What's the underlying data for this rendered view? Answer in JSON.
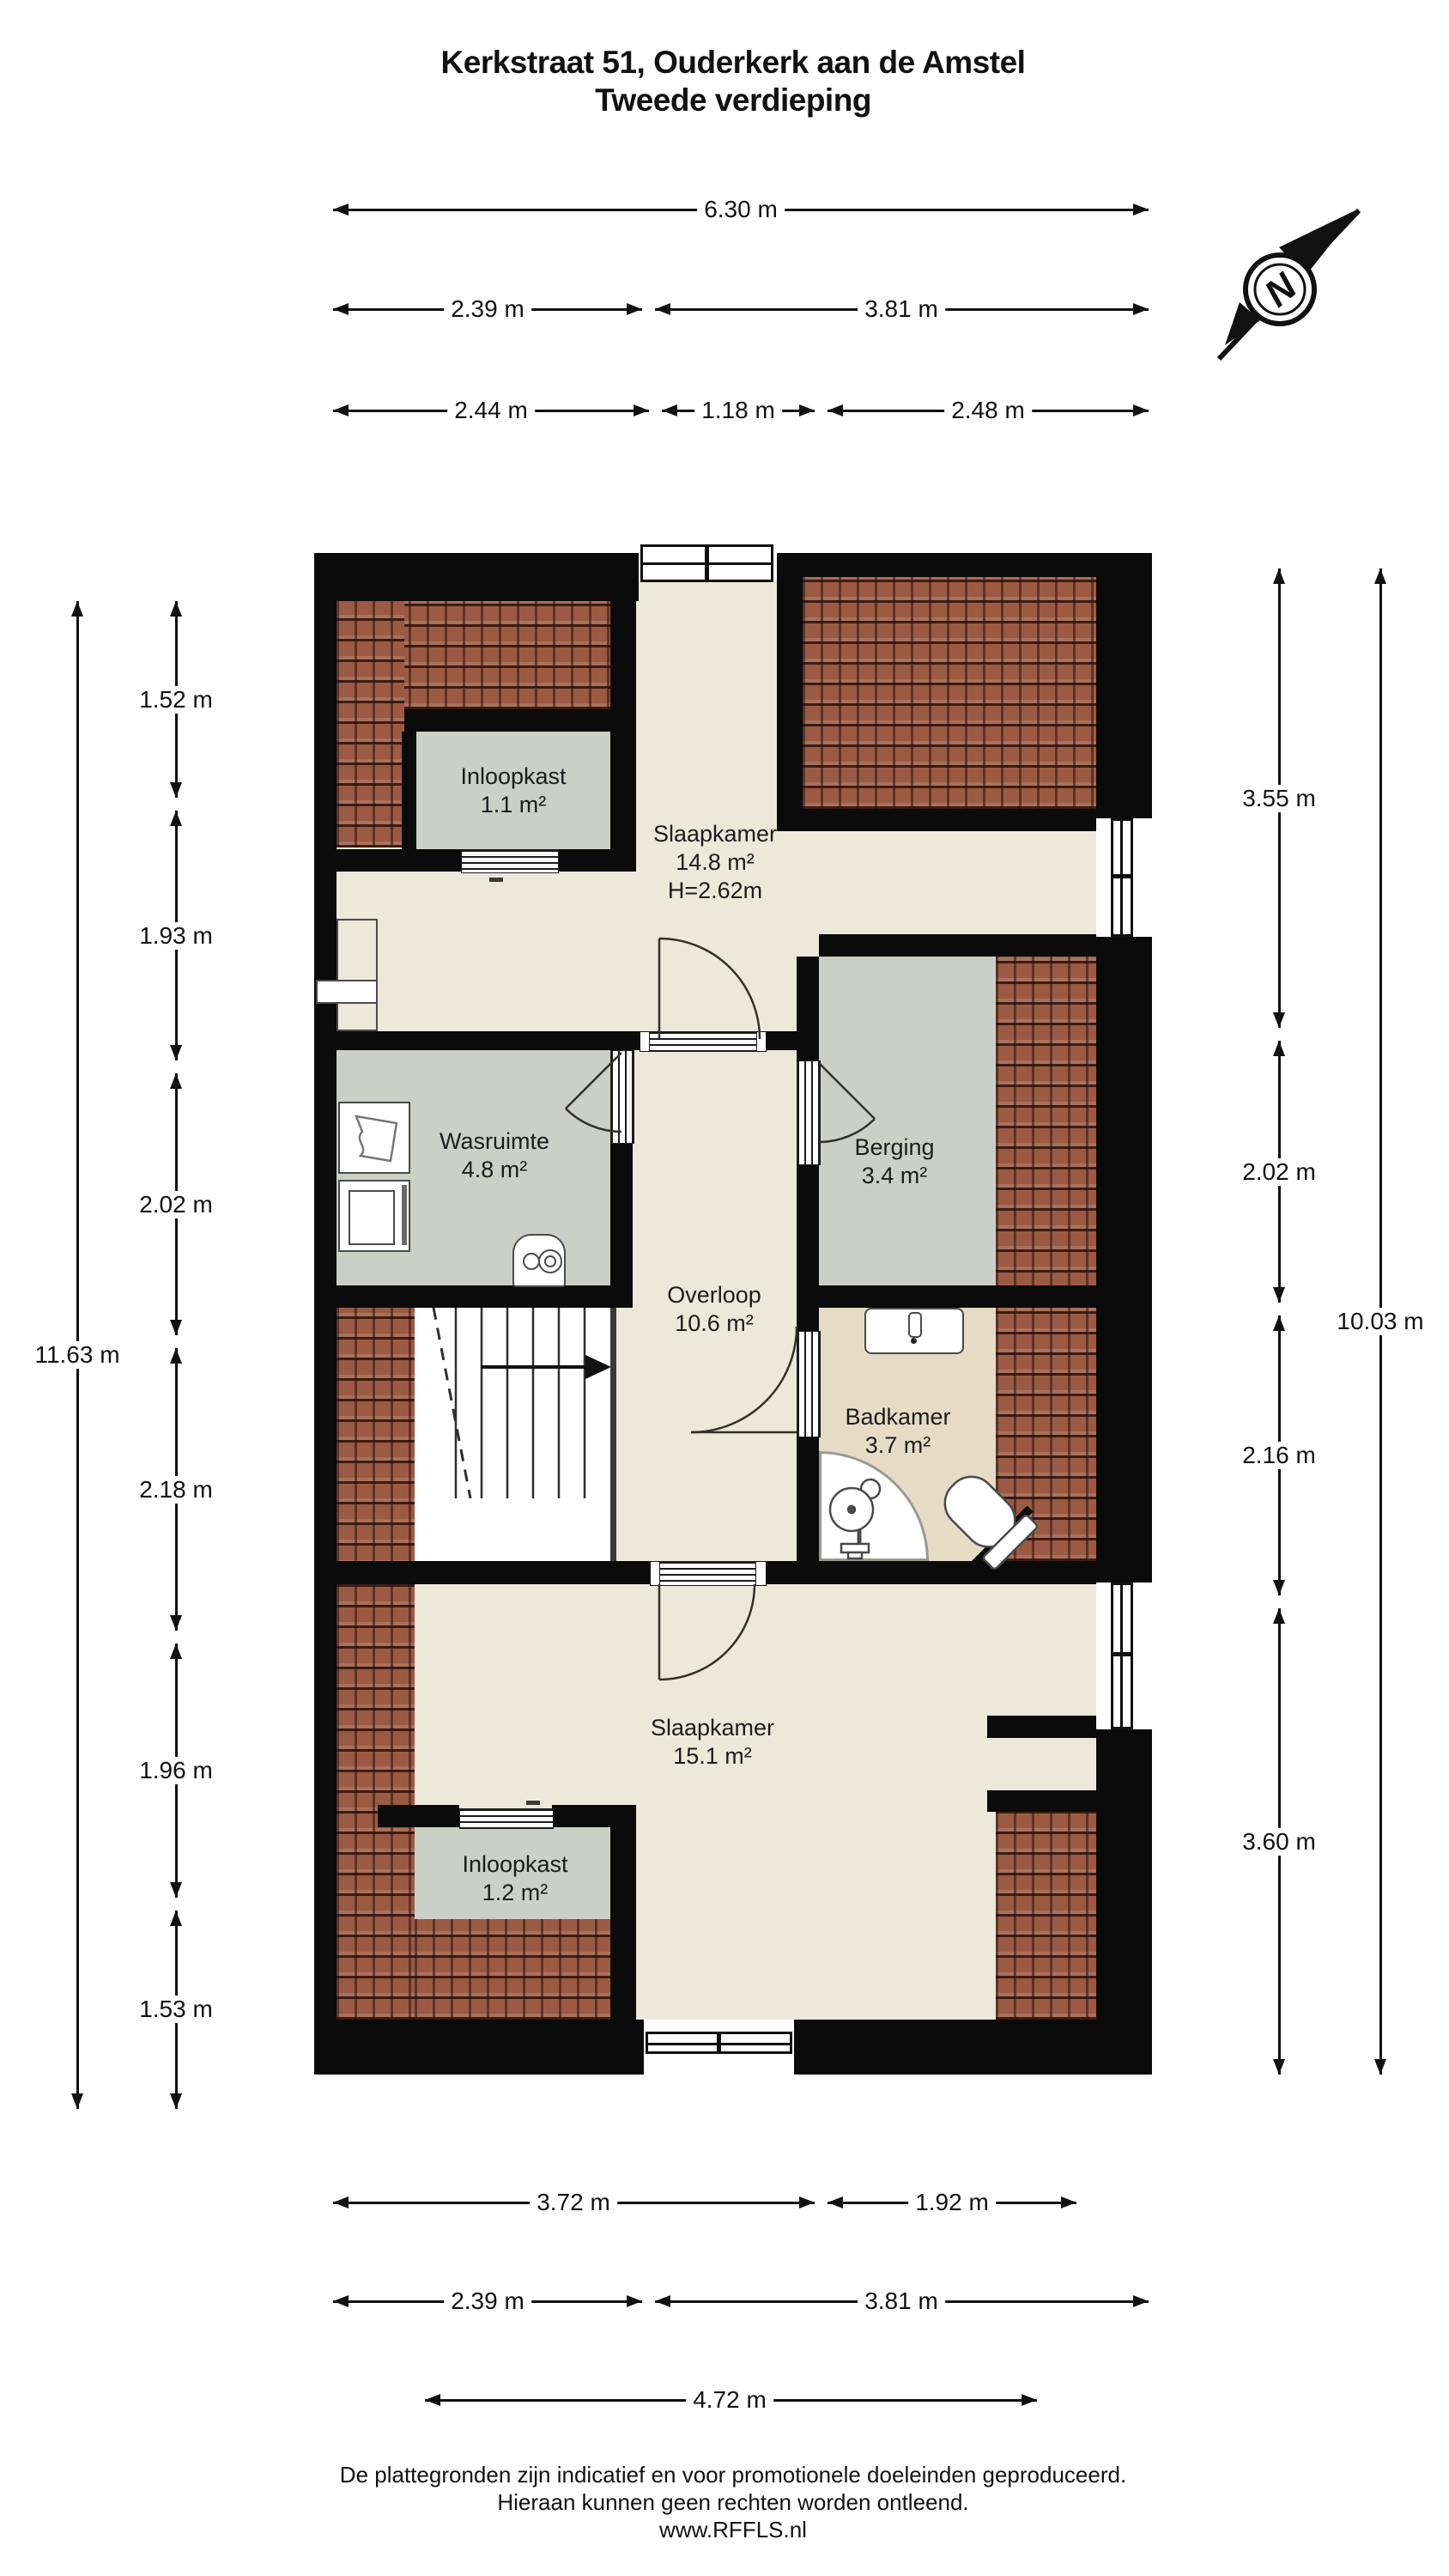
{
  "title": {
    "line1": "Kerkstraat 51, Ouderkerk aan de Amstel",
    "line2": "Tweede verdieping"
  },
  "compass": {
    "label": "N"
  },
  "rooms": [
    {
      "id": "inloopkast1",
      "name": "Inloopkast",
      "area": "1.1 m²"
    },
    {
      "id": "slaapkamer1",
      "name": "Slaapkamer",
      "area": "14.8 m²",
      "note": "H=2.62m"
    },
    {
      "id": "wasruimte",
      "name": "Wasruimte",
      "area": "4.8 m²"
    },
    {
      "id": "berging",
      "name": "Berging",
      "area": "3.4 m²"
    },
    {
      "id": "overloop",
      "name": "Overloop",
      "area": "10.6 m²"
    },
    {
      "id": "badkamer",
      "name": "Badkamer",
      "area": "3.7 m²"
    },
    {
      "id": "slaapkamer2",
      "name": "Slaapkamer",
      "area": "15.1 m²"
    },
    {
      "id": "inloopkast2",
      "name": "Inloopkast",
      "area": "1.2 m²"
    }
  ],
  "dimensions": {
    "top": [
      {
        "id": "t-630",
        "label": "6.30 m"
      },
      {
        "id": "t-239",
        "label": "2.39 m"
      },
      {
        "id": "t-381",
        "label": "3.81 m"
      },
      {
        "id": "t-244",
        "label": "2.44 m"
      },
      {
        "id": "t-118",
        "label": "1.18 m"
      },
      {
        "id": "t-248",
        "label": "2.48 m"
      }
    ],
    "left": [
      {
        "id": "l-1163",
        "label": "11.63 m"
      },
      {
        "id": "l-152",
        "label": "1.52 m"
      },
      {
        "id": "l-193",
        "label": "1.93 m"
      },
      {
        "id": "l-202",
        "label": "2.02 m"
      },
      {
        "id": "l-218",
        "label": "2.18 m"
      },
      {
        "id": "l-196",
        "label": "1.96 m"
      },
      {
        "id": "l-153",
        "label": "1.53 m"
      }
    ],
    "right": [
      {
        "id": "r-355",
        "label": "3.55 m"
      },
      {
        "id": "r-202",
        "label": "2.02 m"
      },
      {
        "id": "r-216",
        "label": "2.16 m"
      },
      {
        "id": "r-360",
        "label": "3.60 m"
      },
      {
        "id": "r-1003",
        "label": "10.03 m"
      }
    ],
    "bottom": [
      {
        "id": "b-372",
        "label": "3.72 m"
      },
      {
        "id": "b-192",
        "label": "1.92 m"
      },
      {
        "id": "b-239",
        "label": "2.39 m"
      },
      {
        "id": "b-381",
        "label": "3.81 m"
      },
      {
        "id": "b-472",
        "label": "4.72 m"
      }
    ]
  },
  "footer": {
    "line1": "De plattegronden zijn indicatief en voor promotionele doeleinden geproduceerd.",
    "line2": "Hieraan kunnen geen rechten worden ontleend.",
    "line3": "www.RFFLS.nl"
  },
  "colors": {
    "wall": "#0b0b0b",
    "floor": "#ece8da",
    "room_gray": "#cbcfc6",
    "bathroom": "#e6dcc6",
    "brick": "#9a5a43"
  }
}
